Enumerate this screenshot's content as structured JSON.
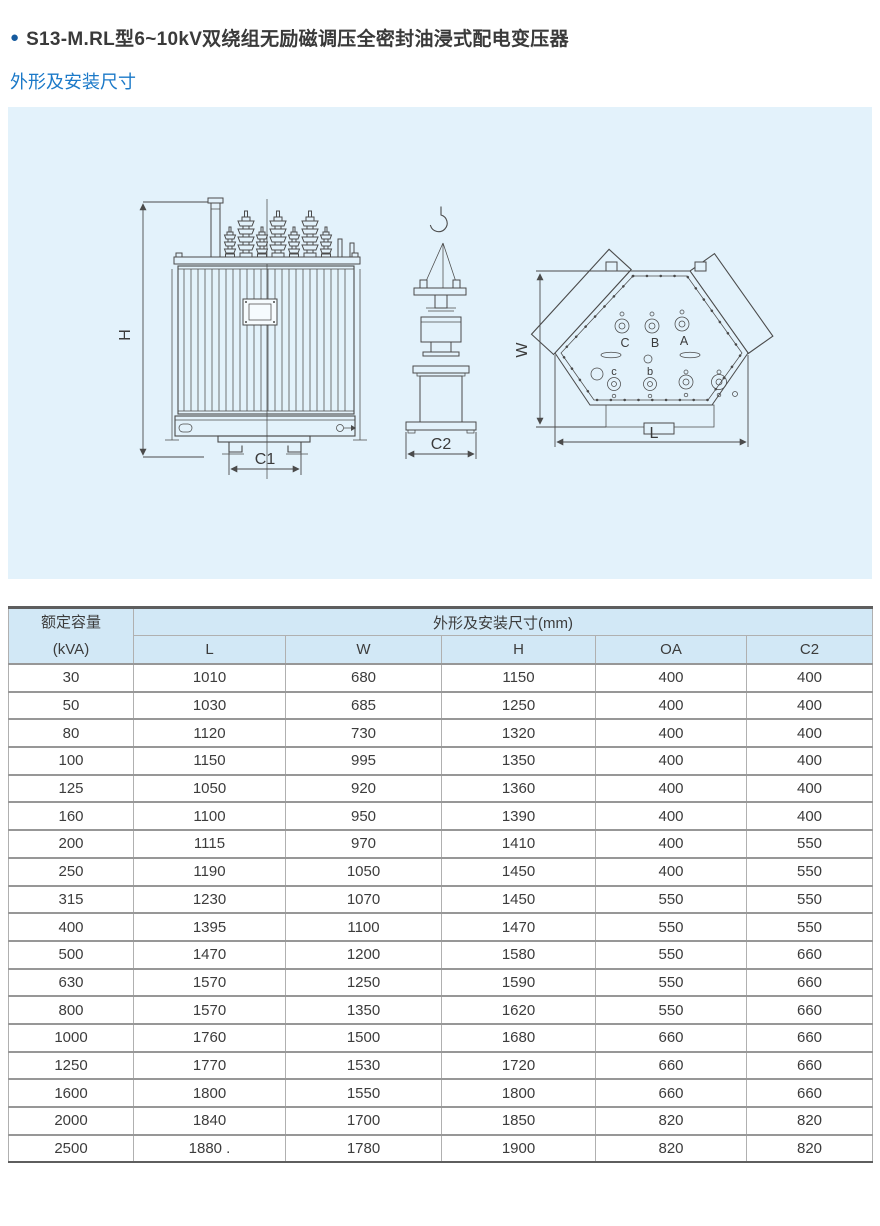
{
  "header": {
    "bullet": "●",
    "title": "S13-M.RL型6~10kV双绕组无励磁调压全密封油浸式配电变压器",
    "subtitle": "外形及安装尺寸"
  },
  "diagram": {
    "front_view": {
      "height_label": "H",
      "base_label": "C1"
    },
    "side_view": {
      "base_label": "C2"
    },
    "top_view": {
      "width_label": "W",
      "length_label": "L",
      "hv_terminals": [
        "C",
        "B",
        "A"
      ],
      "lv_terminals": [
        "c",
        "b"
      ]
    }
  },
  "table": {
    "capacity_header_line1": "额定容量",
    "capacity_header_line2": "(kVA)",
    "group_header": "外形及安装尺寸(mm)",
    "columns": [
      "L",
      "W",
      "H",
      "OA",
      "C2"
    ],
    "rows": [
      [
        "30",
        "1010",
        "680",
        "1150",
        "400",
        "400"
      ],
      [
        "50",
        "1030",
        "685",
        "1250",
        "400",
        "400"
      ],
      [
        "80",
        "1120",
        "730",
        "1320",
        "400",
        "400"
      ],
      [
        "100",
        "1150",
        "995",
        "1350",
        "400",
        "400"
      ],
      [
        "125",
        "1050",
        "920",
        "1360",
        "400",
        "400"
      ],
      [
        "160",
        "1100",
        "950",
        "1390",
        "400",
        "400"
      ],
      [
        "200",
        "1115",
        "970",
        "1410",
        "400",
        "550"
      ],
      [
        "250",
        "1190",
        "1050",
        "1450",
        "400",
        "550"
      ],
      [
        "315",
        "1230",
        "1070",
        "1450",
        "550",
        "550"
      ],
      [
        "400",
        "1395",
        "1100",
        "1470",
        "550",
        "550"
      ],
      [
        "500",
        "1470",
        "1200",
        "1580",
        "550",
        "660"
      ],
      [
        "630",
        "1570",
        "1250",
        "1590",
        "550",
        "660"
      ],
      [
        "800",
        "1570",
        "1350",
        "1620",
        "550",
        "660"
      ],
      [
        "1000",
        "1760",
        "1500",
        "1680",
        "660",
        "660"
      ],
      [
        "1250",
        "1770",
        "1530",
        "1720",
        "660",
        "660"
      ],
      [
        "1600",
        "1800",
        "1550",
        "1800",
        "660",
        "660"
      ],
      [
        "2000",
        "1840",
        "1700",
        "1850",
        "820",
        "820"
      ],
      [
        "2500",
        "1880 .",
        "1780",
        "1900",
        "820",
        "820"
      ]
    ]
  },
  "colors": {
    "accent_blue": "#1b79c8",
    "bullet_blue": "#155a9e",
    "panel_bg": "#e3f2fb",
    "header_bg": "#d2e8f6",
    "line": "#4b4b4b"
  }
}
